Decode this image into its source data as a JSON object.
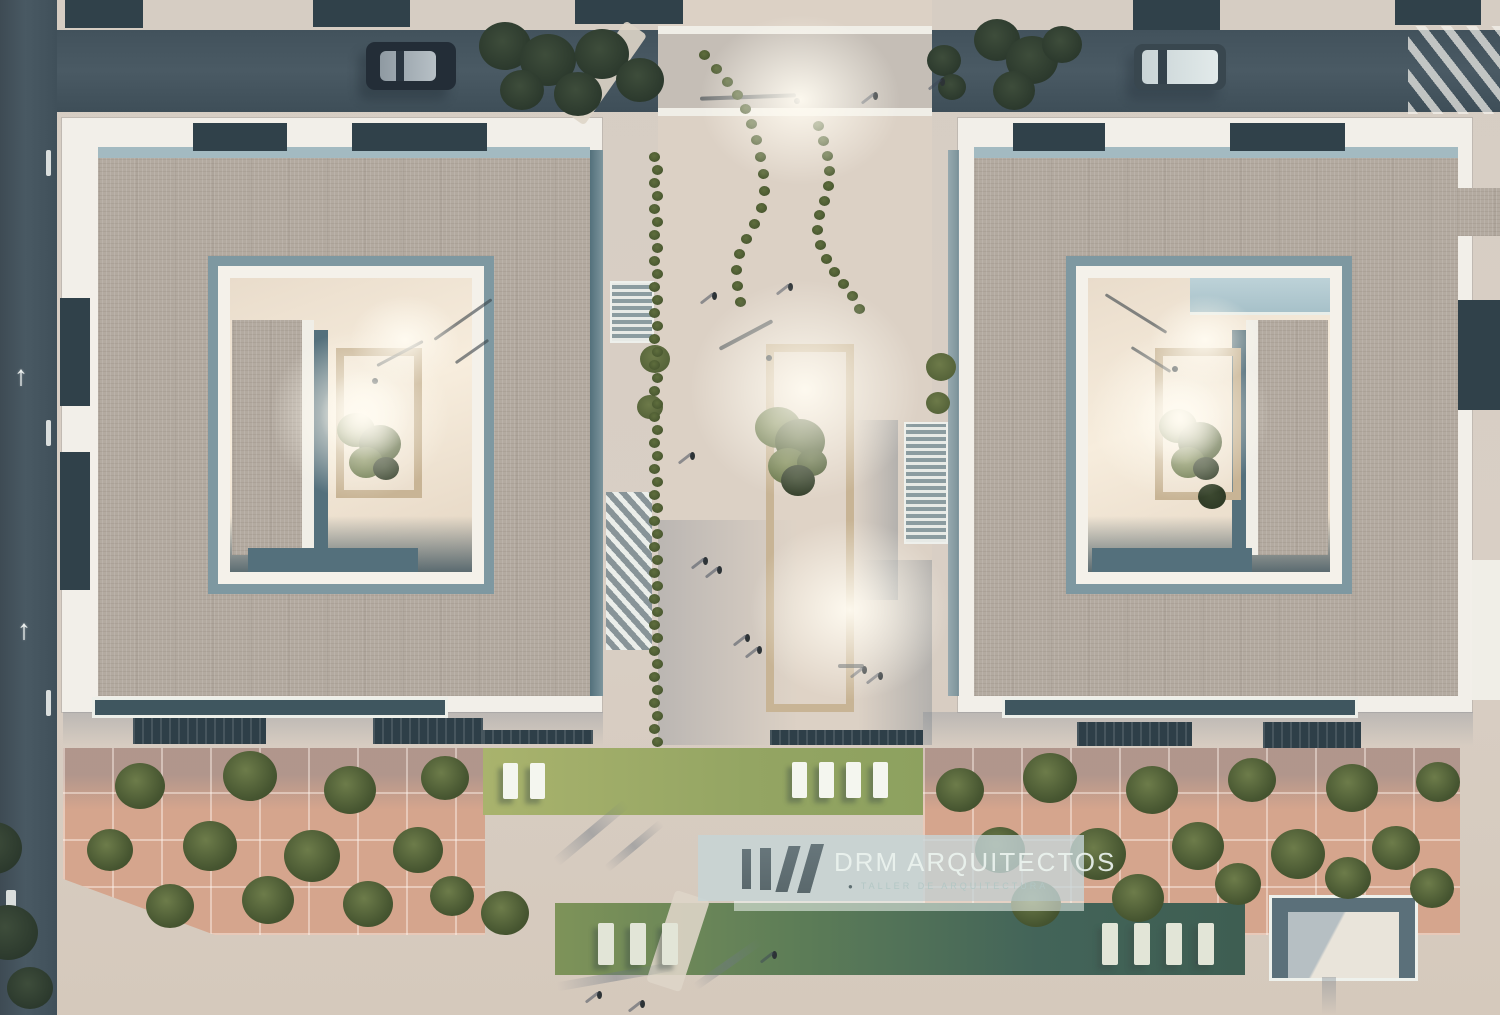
{
  "meta": {
    "title": "Aerial site render — two courtyard buildings with central plaza"
  },
  "watermark": {
    "brand": "DRM ARQUITECTOS",
    "tagline": "TALLER DE ARQUITECTURA",
    "bullet": "●"
  },
  "palette": {
    "road": "#44525b",
    "roof": "#b3aaa0",
    "white_trim": "#f2efe9",
    "teal_shadow": "#54707c",
    "terracotta": "#d5a58d",
    "lawn": "#94a563",
    "lawn_shaded": "#3e5e52",
    "courtyard_glow": "#f7eddd",
    "watermark_panel": "#c5d5d7"
  },
  "road_markings": {
    "arrow_glyph": "↑",
    "arrows": [
      [
        14,
        362
      ],
      [
        17,
        616
      ]
    ]
  },
  "scene": {
    "blocks": [
      [
        658,
        34,
        274,
        74,
        "road-tint"
      ],
      [
        658,
        26,
        274,
        8,
        "white-band"
      ],
      [
        658,
        108,
        274,
        8,
        "white-band"
      ],
      [
        63,
        712,
        540,
        34,
        "shade-top"
      ],
      [
        923,
        712,
        550,
        34,
        "shade-top"
      ],
      [
        658,
        520,
        140,
        225,
        "shade-left"
      ],
      [
        858,
        560,
        74,
        185,
        "shade-right"
      ],
      [
        854,
        420,
        44,
        180,
        "shade-right"
      ],
      [
        65,
        0,
        78,
        28,
        "balcony-inset"
      ],
      [
        313,
        0,
        97,
        27,
        "balcony-inset"
      ],
      [
        575,
        0,
        108,
        24,
        "balcony-inset"
      ],
      [
        1133,
        0,
        87,
        30,
        "balcony-inset"
      ],
      [
        1395,
        0,
        86,
        25,
        "balcony-inset"
      ],
      [
        193,
        123,
        94,
        28,
        "balcony-inset"
      ],
      [
        352,
        123,
        135,
        28,
        "balcony-inset"
      ],
      [
        1013,
        123,
        92,
        28,
        "balcony-inset"
      ],
      [
        1230,
        123,
        115,
        28,
        "balcony-inset"
      ],
      [
        60,
        298,
        30,
        108,
        "balcony-inset"
      ],
      [
        60,
        452,
        30,
        138,
        "balcony-inset"
      ],
      [
        1458,
        300,
        42,
        110,
        "balcony-inset"
      ],
      [
        95,
        700,
        350,
        15,
        "balcony-bar"
      ],
      [
        1005,
        700,
        350,
        15,
        "balcony-bar"
      ],
      [
        133,
        718,
        133,
        26,
        "balcony-bar-dark"
      ],
      [
        373,
        718,
        110,
        26,
        "balcony-bar-dark"
      ],
      [
        1077,
        722,
        115,
        24,
        "balcony-bar-dark"
      ],
      [
        1263,
        722,
        98,
        26,
        "balcony-bar-dark"
      ],
      [
        483,
        730,
        110,
        14,
        "balcony-bar-dark"
      ],
      [
        770,
        730,
        153,
        15,
        "balcony-bar-dark"
      ],
      [
        590,
        150,
        13,
        546,
        "facade-shadow"
      ],
      [
        948,
        150,
        11,
        546,
        "facade-shadow-light"
      ],
      [
        612,
        283,
        40,
        58,
        "stairs"
      ],
      [
        906,
        424,
        40,
        118,
        "stairs"
      ],
      [
        606,
        492,
        46,
        158,
        "ramp"
      ],
      [
        1190,
        278,
        140,
        34,
        "glass-canopy"
      ],
      [
        232,
        320,
        70,
        235,
        "roof-patch"
      ],
      [
        302,
        320,
        12,
        235,
        "white-band"
      ],
      [
        314,
        330,
        14,
        225,
        "shadow-band"
      ],
      [
        248,
        548,
        170,
        24,
        "shadow-band"
      ],
      [
        1258,
        320,
        70,
        235,
        "roof-patch"
      ],
      [
        1246,
        320,
        12,
        235,
        "white-band"
      ],
      [
        1232,
        330,
        14,
        225,
        "shadow-band"
      ],
      [
        1092,
        548,
        160,
        24,
        "shadow-band"
      ],
      [
        1456,
        188,
        44,
        48,
        "roof-patch"
      ],
      [
        1472,
        560,
        28,
        140,
        "white-band"
      ],
      [
        766,
        344,
        88,
        368,
        "planter"
      ],
      [
        336,
        348,
        86,
        150,
        "planter"
      ],
      [
        1155,
        348,
        86,
        152,
        "planter"
      ],
      [
        700,
        95,
        96,
        4,
        "pole-shadow",
        -2
      ],
      [
        716,
        333,
        60,
        4,
        "pole-shadow",
        -28
      ],
      [
        374,
        352,
        52,
        3,
        "pole-shadow",
        -28
      ],
      [
        428,
        318,
        70,
        3,
        "pole-shadow",
        -35
      ],
      [
        452,
        350,
        40,
        3,
        "pole-shadow",
        -35
      ],
      [
        1100,
        312,
        72,
        3,
        "pole-shadow",
        32
      ],
      [
        1128,
        358,
        46,
        3,
        "pole-shadow",
        32
      ],
      [
        838,
        664,
        26,
        4,
        "pole-shadow"
      ],
      [
        6,
        890,
        10,
        28,
        "road-marking"
      ],
      [
        46,
        150,
        5,
        26,
        "road-marking"
      ],
      [
        46,
        420,
        5,
        26,
        "road-marking"
      ],
      [
        46,
        690,
        5,
        26,
        "road-marking"
      ],
      [
        1408,
        26,
        92,
        88,
        "crosswalk"
      ],
      [
        592,
        18,
        26,
        110,
        "footpath",
        35
      ],
      [
        660,
        893,
        36,
        96,
        "footpath",
        18
      ],
      [
        545,
        828,
        92,
        10,
        "shadow-streak",
        -40
      ],
      [
        598,
        842,
        72,
        8,
        "shadow-streak",
        -40
      ],
      [
        556,
        972,
        120,
        9,
        "shadow-streak",
        -10
      ],
      [
        688,
        960,
        80,
        8,
        "shadow-streak",
        -35
      ],
      [
        1322,
        977,
        14,
        38,
        "streak-v"
      ]
    ],
    "trees": [
      [
        140,
        788,
        50,
        "terra-t"
      ],
      [
        250,
        778,
        54,
        "terra-t"
      ],
      [
        350,
        792,
        52,
        "terra-t"
      ],
      [
        445,
        780,
        48,
        "terra-t"
      ],
      [
        110,
        852,
        46,
        "terra-t"
      ],
      [
        210,
        848,
        54,
        "terra-t"
      ],
      [
        312,
        858,
        56,
        "terra-t"
      ],
      [
        418,
        852,
        50,
        "terra-t"
      ],
      [
        170,
        908,
        48,
        "terra-t"
      ],
      [
        268,
        902,
        52,
        "terra-t"
      ],
      [
        368,
        906,
        50,
        "terra-t"
      ],
      [
        452,
        898,
        44,
        "terra-t"
      ],
      [
        505,
        915,
        48,
        "terra-t"
      ],
      [
        960,
        792,
        48,
        "terra-t"
      ],
      [
        1050,
        780,
        54,
        "terra-t"
      ],
      [
        1152,
        792,
        52,
        "terra-t"
      ],
      [
        1252,
        782,
        48,
        "terra-t"
      ],
      [
        1352,
        790,
        52,
        "terra-t"
      ],
      [
        1438,
        784,
        44,
        "terra-t"
      ],
      [
        1000,
        852,
        50,
        "terra-t"
      ],
      [
        1098,
        856,
        56,
        "terra-t"
      ],
      [
        1198,
        848,
        52,
        "terra-t"
      ],
      [
        1298,
        856,
        54,
        "terra-t"
      ],
      [
        1396,
        850,
        48,
        "terra-t"
      ],
      [
        1036,
        906,
        50,
        "terra-t"
      ],
      [
        1138,
        900,
        52,
        "terra-t"
      ],
      [
        1238,
        886,
        46,
        "terra-t"
      ],
      [
        1348,
        880,
        46,
        "terra-t"
      ],
      [
        1432,
        890,
        44,
        "terra-t"
      ],
      [
        505,
        48,
        52,
        "dark-t"
      ],
      [
        548,
        62,
        56,
        "dark-t"
      ],
      [
        602,
        56,
        54,
        "dark-t"
      ],
      [
        640,
        82,
        48,
        "dark-t"
      ],
      [
        522,
        92,
        44,
        "dark-t"
      ],
      [
        578,
        96,
        48,
        "dark-t"
      ],
      [
        997,
        42,
        46,
        "dark-t"
      ],
      [
        1032,
        62,
        52,
        "dark-t"
      ],
      [
        1014,
        92,
        42,
        "dark-t"
      ],
      [
        1062,
        46,
        40,
        "dark-t"
      ],
      [
        944,
        62,
        34,
        "dark-t"
      ],
      [
        952,
        88,
        28,
        "dark-t"
      ],
      [
        -6,
        850,
        56,
        "dark-t"
      ],
      [
        8,
        935,
        60,
        "dark-t"
      ],
      [
        30,
        990,
        46,
        "dark-t"
      ],
      [
        941,
        368,
        30,
        "olive-t"
      ],
      [
        938,
        404,
        24,
        "olive-t"
      ],
      [
        655,
        360,
        30,
        "olive-t"
      ],
      [
        650,
        408,
        26,
        "olive-t"
      ]
    ],
    "chains": [
      [
        [
          704,
          55
        ],
        [
          716,
          69
        ],
        [
          727,
          82
        ],
        [
          737,
          95
        ],
        [
          745,
          109
        ],
        [
          751,
          124
        ],
        [
          756,
          140
        ],
        [
          760,
          157
        ],
        [
          763,
          174
        ],
        [
          764,
          191
        ],
        [
          761,
          208
        ],
        [
          754,
          224
        ],
        [
          746,
          239
        ],
        [
          739,
          254
        ],
        [
          736,
          270
        ],
        [
          737,
          286
        ],
        [
          740,
          302
        ]
      ],
      [
        [
          818,
          126
        ],
        [
          823,
          141
        ],
        [
          827,
          156
        ],
        [
          829,
          171
        ],
        [
          828,
          186
        ],
        [
          824,
          201
        ],
        [
          819,
          215
        ],
        [
          817,
          230
        ],
        [
          820,
          245
        ],
        [
          826,
          259
        ],
        [
          834,
          272
        ],
        [
          843,
          284
        ],
        [
          852,
          296
        ],
        [
          859,
          309
        ]
      ]
    ],
    "hedge_row": {
      "x": 654,
      "y0": 152,
      "y1": 745,
      "step": 13
    },
    "plants": [
      [
        778,
        430,
        46,
        0
      ],
      [
        800,
        444,
        50,
        1
      ],
      [
        788,
        468,
        40,
        0
      ],
      [
        812,
        464,
        30,
        1
      ],
      [
        798,
        482,
        34,
        2
      ],
      [
        356,
        432,
        38,
        0
      ],
      [
        380,
        446,
        42,
        1
      ],
      [
        366,
        464,
        34,
        0
      ],
      [
        386,
        470,
        26,
        2
      ],
      [
        1178,
        428,
        38,
        0
      ],
      [
        1200,
        444,
        44,
        1
      ],
      [
        1188,
        464,
        34,
        0
      ],
      [
        1206,
        470,
        26,
        2
      ],
      [
        1212,
        498,
        28,
        2
      ]
    ],
    "people": [
      [
        873,
        92
      ],
      [
        940,
        78
      ],
      [
        788,
        283
      ],
      [
        712,
        292
      ],
      [
        690,
        452
      ],
      [
        703,
        557
      ],
      [
        717,
        566
      ],
      [
        745,
        634
      ],
      [
        757,
        646
      ],
      [
        878,
        672
      ],
      [
        862,
        666
      ],
      [
        597,
        991
      ],
      [
        640,
        1000
      ],
      [
        772,
        951
      ],
      [
        1207,
        952
      ]
    ],
    "dots": [
      [
        794,
        98
      ],
      [
        766,
        355
      ],
      [
        372,
        378
      ],
      [
        1172,
        366
      ]
    ],
    "loungers": {
      "upper": [
        [
          503,
          763
        ],
        [
          530,
          763
        ],
        [
          792,
          762
        ],
        [
          819,
          762
        ],
        [
          846,
          762
        ],
        [
          873,
          762
        ]
      ],
      "lower": [
        [
          598,
          923
        ],
        [
          630,
          923
        ],
        [
          662,
          923
        ],
        [
          1102,
          923
        ],
        [
          1134,
          923
        ],
        [
          1166,
          923
        ],
        [
          1198,
          923
        ]
      ]
    },
    "glows": [
      [
        700,
        15,
        200,
        170
      ],
      [
        690,
        280,
        230,
        220
      ],
      [
        750,
        520,
        200,
        180
      ],
      [
        270,
        330,
        180,
        170
      ],
      [
        320,
        370,
        90,
        90
      ],
      [
        350,
        295,
        110,
        90
      ],
      [
        1090,
        330,
        180,
        170
      ],
      [
        1135,
        375,
        90,
        90
      ],
      [
        1150,
        295,
        110,
        90
      ]
    ]
  }
}
